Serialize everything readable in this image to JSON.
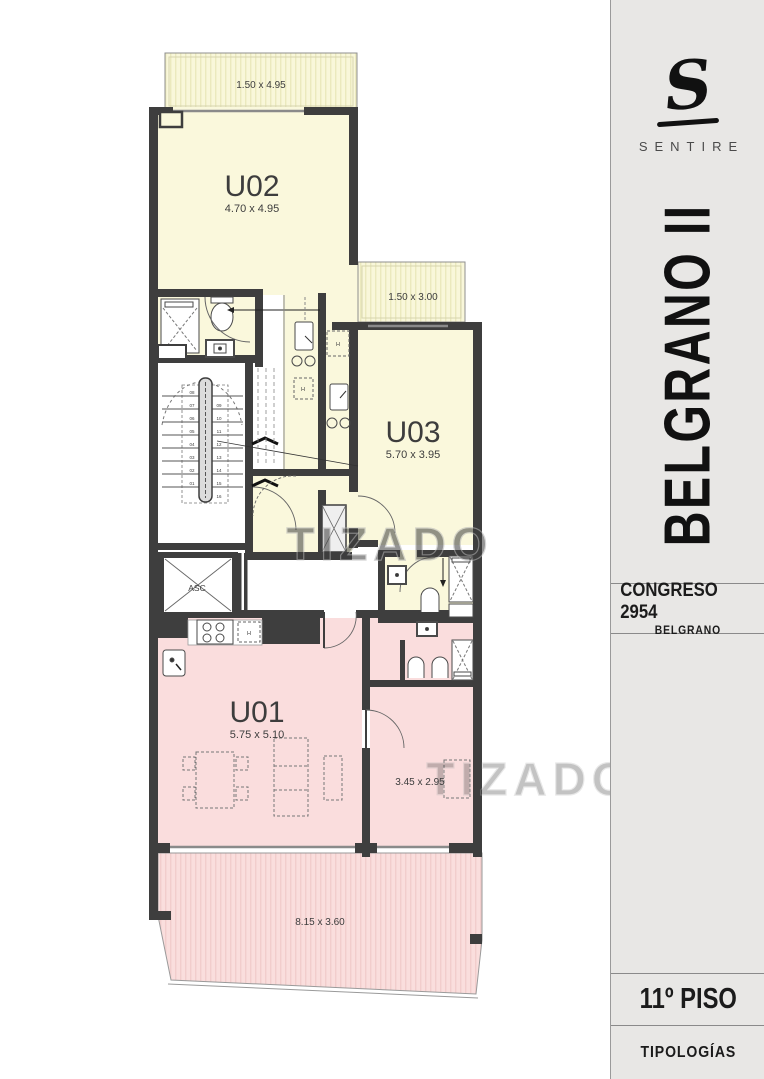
{
  "sidebar": {
    "logo_letter": "S",
    "brand": "SENTIRE",
    "project_title": "BELGRANO II",
    "address": "CONGRESO 2954",
    "neighborhood": "BELGRANO",
    "floor_label": "11º PISO",
    "section_label": "TIPOLOGÍAS"
  },
  "plan": {
    "watermark": "TIZADO",
    "units": [
      {
        "id": "U02",
        "dims": "4.70 x 4.95",
        "balcony": "1.50 x 4.95"
      },
      {
        "id": "U03",
        "dims": "5.70 x 3.95",
        "balcony": "1.50 x 3.00"
      },
      {
        "id": "U01",
        "dims": "5.75 x 5.10",
        "bedroom": "3.45 x 2.95",
        "terrace": "8.15 x 3.60"
      }
    ],
    "elevator": "ASC",
    "closet": "H",
    "stairs_left": [
      "08",
      "07",
      "06",
      "05",
      "04",
      "03",
      "02",
      "01"
    ],
    "stairs_right": [
      "09",
      "10",
      "11",
      "12",
      "13",
      "14",
      "15",
      "16"
    ],
    "colors": {
      "unit_warm": "#faf8dc",
      "unit_pink": "#fadddd",
      "wall": "#3e3e3e",
      "sidebar_bg": "#e8e7e5"
    }
  }
}
